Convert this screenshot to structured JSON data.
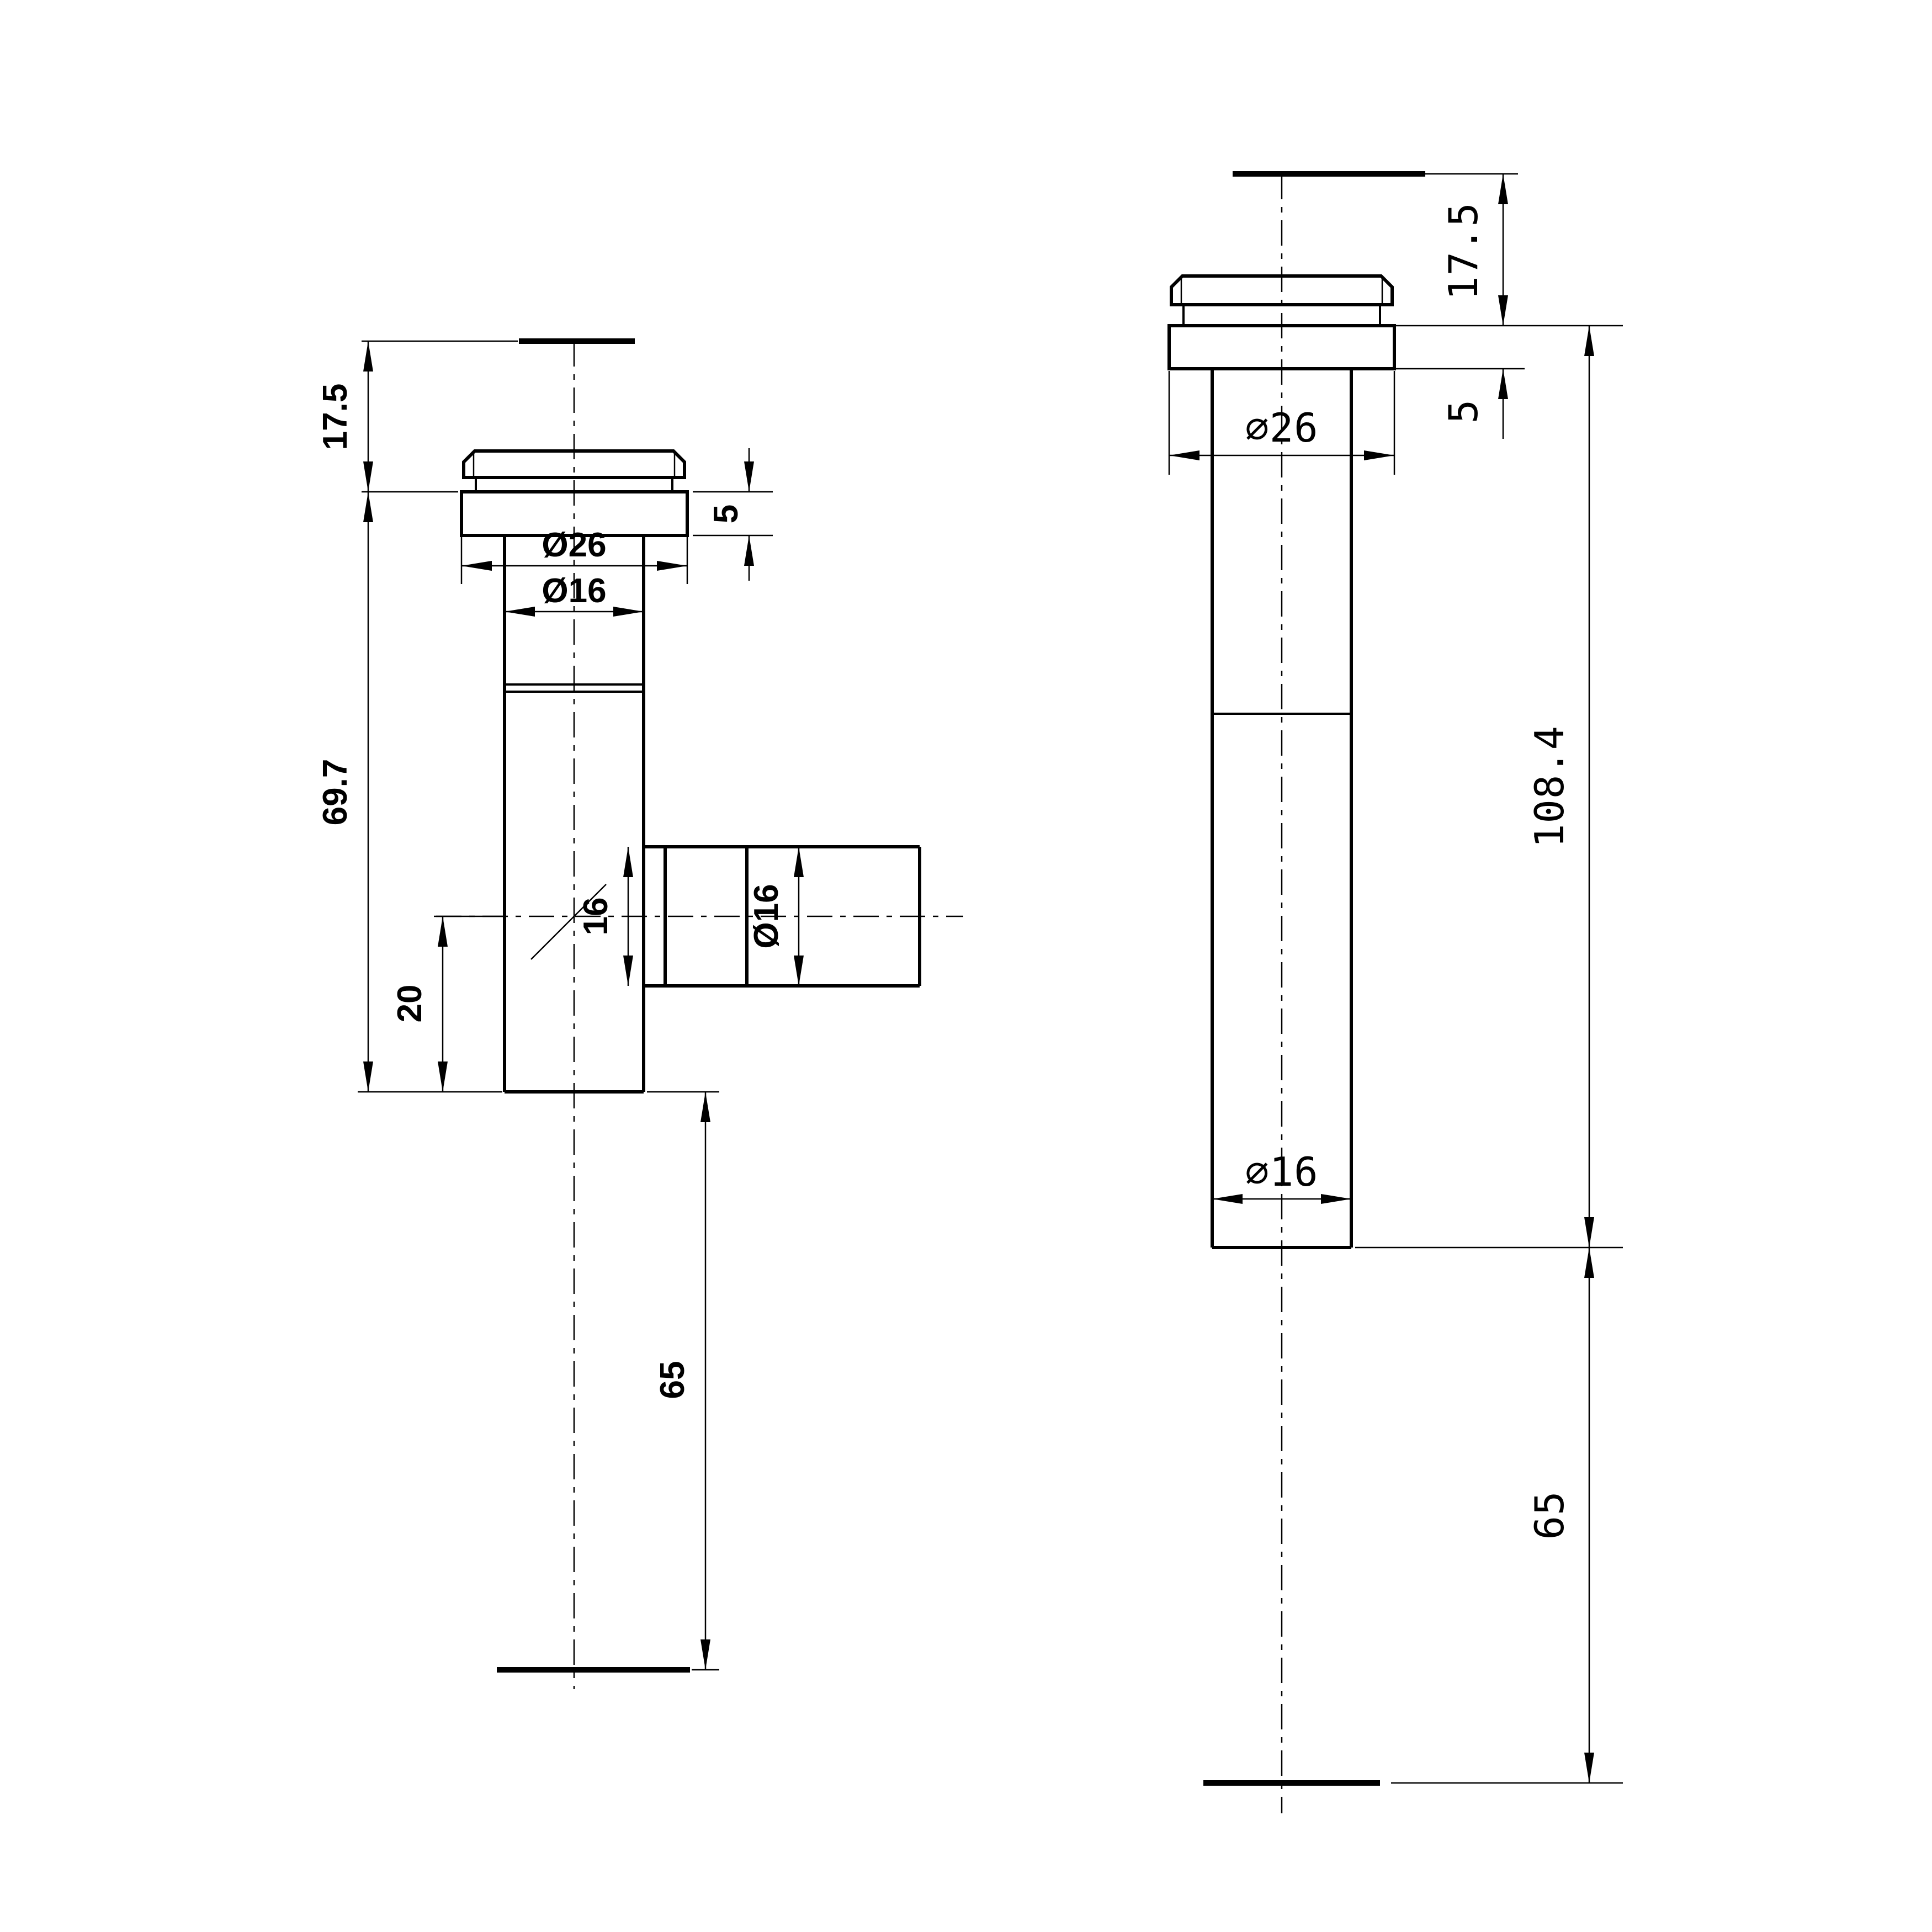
{
  "colors": {
    "ink": "#000000",
    "background": "#ffffff"
  },
  "left": {
    "cap_height": "17.5",
    "flange_thickness": "5",
    "flange_diameter": "Ø26",
    "neck_diameter": "Ø16",
    "body_length": "69.7",
    "branch_bore": "16",
    "branch_diameter": "Ø16",
    "outlet_offset": "20",
    "tail_length": "65"
  },
  "right": {
    "cap_height": "17.5",
    "flange_diameter": "∅26",
    "flange_thickness": "5",
    "overall_length": "108.4",
    "tube_diameter": "∅16",
    "tail_length": "65"
  }
}
